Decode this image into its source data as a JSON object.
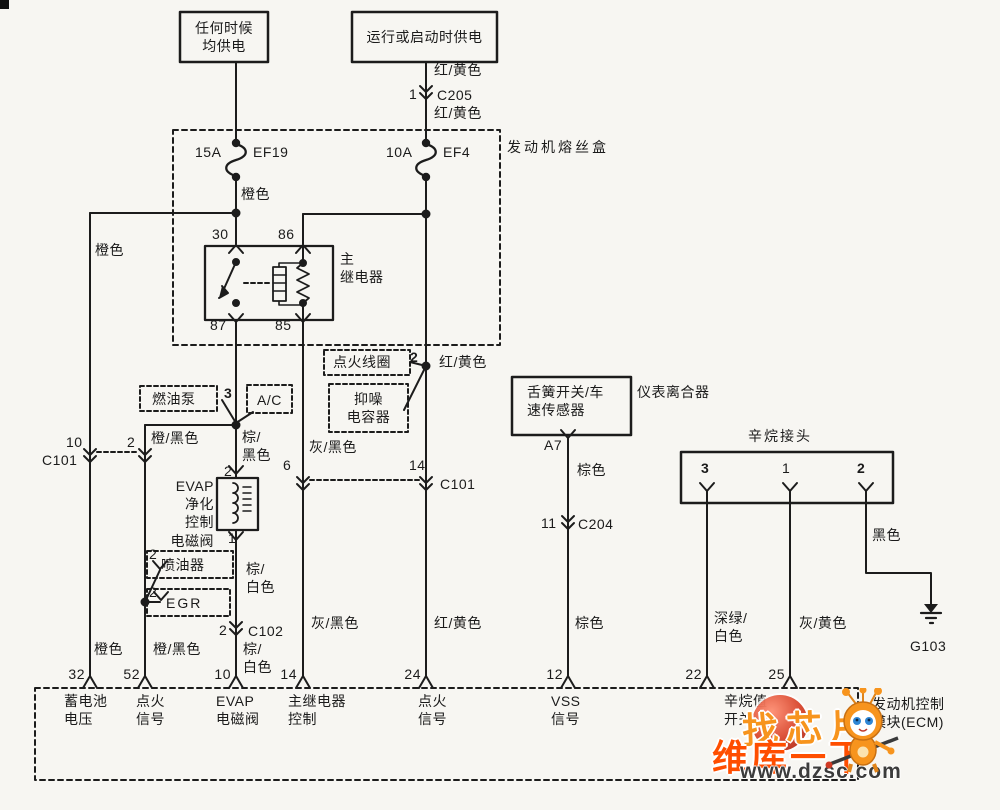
{
  "power": {
    "always_box": "任何时候\n均供电",
    "run_start_box": "运行或启动时供电",
    "red_yellow_a": "红/黄色",
    "c205_pin": "1",
    "c205": "C205",
    "red_yellow_b": "红/黄色"
  },
  "fusebox": {
    "label": "发动机熔丝盒",
    "ef19_amp": "15A",
    "ef19": "EF19",
    "ef4_amp": "10A",
    "ef4": "EF4"
  },
  "relay": {
    "label": "主\n继电器",
    "pin_30": "30",
    "pin_86": "86",
    "pin_87": "87",
    "pin_85": "85"
  },
  "components": {
    "ignition_coil": "点火线圈",
    "ignition_coil_pin": "2",
    "noise_capacitor": "抑噪\n电容器",
    "fuel_pump": "燃油泵",
    "fuel_pump_pin": "3",
    "ac": "A/C",
    "evap_valve": "EVAP\n净化\n控制\n电磁阀",
    "evap_pin_top": "2",
    "evap_pin_bottom": "1",
    "injector": "喷油器",
    "injector_pin": "2",
    "egr": "EGR",
    "egr_pin": "2",
    "vss": "舌簧开关/车\n速传感器",
    "vss_aux_label": "仪表离合器",
    "vss_pin": "A7",
    "octane_connector": "辛烷接头",
    "octane_pin_3": "3",
    "octane_pin_1": "1",
    "octane_pin_2": "2",
    "ground": "G103"
  },
  "inline_connectors": {
    "c101_left": {
      "pin_a": "10",
      "pin_b": "2",
      "name": "C101"
    },
    "c101_right": {
      "pin_a": "6",
      "pin_b": "14",
      "name": "C101"
    },
    "c204": {
      "pin": "11",
      "name": "C204"
    },
    "c102": {
      "pin": "2",
      "name": "C102"
    }
  },
  "wire_colors": {
    "orange_fuse": "橙色",
    "orange_left_top": "橙色",
    "orange_left_bottom": "橙色",
    "orange_black_top": "橙/黑色",
    "orange_black_bottom": "橙/黑色",
    "brown_black": "棕/\n黑色",
    "gray_black_top": "灰/黑色",
    "gray_black_bottom": "灰/黑色",
    "brown_white_top": "棕/\n白色",
    "brown_white_bottom": "棕/\n白色",
    "red_yellow_junction": "红/黄色",
    "red_yellow_bottom": "红/黄色",
    "brown_top": "棕色",
    "brown_bottom": "棕色",
    "dark_green_white": "深绿/\n白色",
    "gray_yellow": "灰/黄色",
    "black": "黑色"
  },
  "ecm": {
    "label": "发动机控制\n模块(ECM)",
    "octane_switch_label": "辛烷值\n开关",
    "pins": [
      {
        "num": "32",
        "label": "蓄电池\n电压"
      },
      {
        "num": "52",
        "label": "点火\n信号"
      },
      {
        "num": "10",
        "label": "EVAP\n电磁阀"
      },
      {
        "num": "14",
        "label": "主继电器\n控制"
      },
      {
        "num": "24",
        "label": "点火\n信号"
      },
      {
        "num": "12",
        "label": "VSS\n信号"
      },
      {
        "num": "22",
        "label": ""
      },
      {
        "num": "25",
        "label": ""
      }
    ]
  },
  "watermark": {
    "logo_text": "找芯片",
    "brand": "维库一下",
    "url": "www.dzsc.com"
  }
}
